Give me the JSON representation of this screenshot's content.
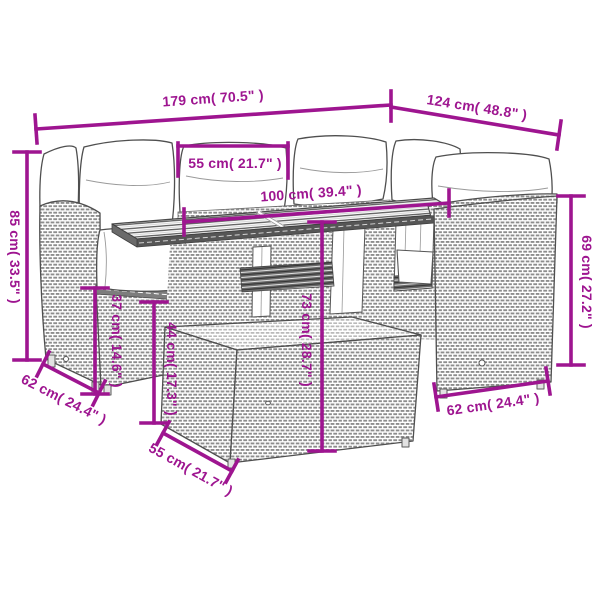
{
  "diagram": {
    "background_color": "#ffffff",
    "accent_color": "#9E1590",
    "lineart_color": "#4f4f4f",
    "subject": "garden furniture set line drawing with dimension arrows",
    "dimensions": [
      {
        "id": "d179",
        "label": "179 cm( 70.5\" )"
      },
      {
        "id": "d124",
        "label": "124 cm( 48.8\" )"
      },
      {
        "id": "d55top",
        "label": "55 cm( 21.7\" )"
      },
      {
        "id": "d100",
        "label": "100 cm( 39.4\" )"
      },
      {
        "id": "d85",
        "label": "85 cm( 33.5\" )"
      },
      {
        "id": "d37",
        "label": "37 cm( 14.6\" )"
      },
      {
        "id": "d44",
        "label": "44 cm( 17.3\" )"
      },
      {
        "id": "d73",
        "label": "73 cm( 28.7\" )"
      },
      {
        "id": "d69",
        "label": "69 cm( 27.2\" )"
      },
      {
        "id": "d62left",
        "label": "62 cm( 24.4\" )"
      },
      {
        "id": "d55bottom",
        "label": "55 cm( 21.7\" )"
      },
      {
        "id": "d62right",
        "label": "62 cm( 24.4\" )"
      }
    ]
  }
}
